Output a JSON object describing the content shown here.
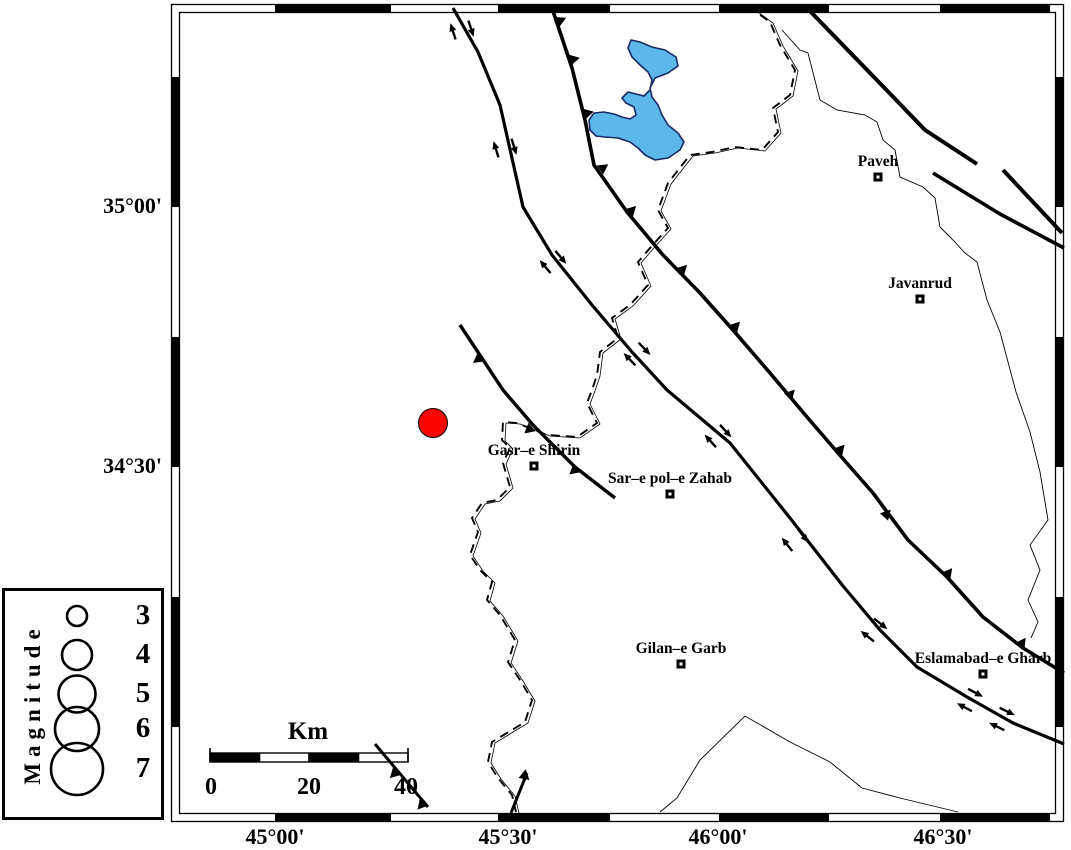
{
  "map": {
    "colors": {
      "water": "#5cb8e8",
      "water_outline": "#1a2a66",
      "epicenter": "#fa0400",
      "line": "#000000"
    },
    "frame": {
      "outer": [
        171.5,
        4.5,
        1063.5,
        821.5
      ],
      "inner": [
        179.5,
        12.5,
        1055.5,
        813.5
      ],
      "top_segs": [
        [
          275,
          391
        ],
        [
          498,
          610
        ],
        [
          719,
          829
        ],
        [
          940,
          1050
        ]
      ],
      "bottom_segs": [
        [
          275,
          391
        ],
        [
          498,
          610
        ],
        [
          719,
          829
        ],
        [
          940,
          1050
        ]
      ],
      "left_segs": [
        [
          77,
          207
        ],
        [
          337,
          467
        ],
        [
          597,
          727
        ]
      ],
      "right_segs": [
        [
          77,
          207
        ],
        [
          337,
          467
        ],
        [
          597,
          727
        ]
      ]
    },
    "axis": {
      "left": [
        {
          "text": "35°00'",
          "y": 207
        },
        {
          "text": "34°30'",
          "y": 467
        }
      ],
      "bottom": [
        {
          "text": "45°00'",
          "x": 275
        },
        {
          "text": "45°30'",
          "x": 508
        },
        {
          "text": "46°00'",
          "x": 718
        },
        {
          "text": "46°30'",
          "x": 943
        }
      ]
    },
    "lake": {
      "points": [
        [
          631,
          40
        ],
        [
          640,
          42
        ],
        [
          652,
          47
        ],
        [
          665,
          50
        ],
        [
          676,
          57
        ],
        [
          678,
          66
        ],
        [
          668,
          73
        ],
        [
          655,
          78
        ],
        [
          650,
          88
        ],
        [
          652,
          97
        ],
        [
          658,
          105
        ],
        [
          662,
          115
        ],
        [
          668,
          125
        ],
        [
          678,
          133
        ],
        [
          684,
          142
        ],
        [
          680,
          150
        ],
        [
          668,
          158
        ],
        [
          655,
          160
        ],
        [
          645,
          155
        ],
        [
          638,
          148
        ],
        [
          630,
          142
        ],
        [
          618,
          138
        ],
        [
          605,
          137
        ],
        [
          596,
          136
        ],
        [
          590,
          130
        ],
        [
          589,
          120
        ],
        [
          594,
          113
        ],
        [
          604,
          112
        ],
        [
          614,
          114
        ],
        [
          622,
          117
        ],
        [
          630,
          119
        ],
        [
          636,
          115
        ],
        [
          634,
          107
        ],
        [
          626,
          103
        ],
        [
          622,
          98
        ],
        [
          628,
          92
        ],
        [
          636,
          94
        ],
        [
          644,
          96
        ],
        [
          650,
          90
        ],
        [
          652,
          80
        ],
        [
          648,
          72
        ],
        [
          640,
          65
        ],
        [
          632,
          57
        ],
        [
          628,
          48
        ]
      ]
    },
    "border": {
      "points": [
        [
          748,
          6
        ],
        [
          770,
          22
        ],
        [
          780,
          45
        ],
        [
          795,
          70
        ],
        [
          790,
          95
        ],
        [
          773,
          108
        ],
        [
          778,
          132
        ],
        [
          762,
          150
        ],
        [
          735,
          147
        ],
        [
          712,
          152
        ],
        [
          690,
          155
        ],
        [
          668,
          183
        ],
        [
          658,
          210
        ],
        [
          668,
          228
        ],
        [
          650,
          248
        ],
        [
          638,
          262
        ],
        [
          648,
          285
        ],
        [
          630,
          305
        ],
        [
          612,
          318
        ],
        [
          618,
          338
        ],
        [
          600,
          352
        ],
        [
          597,
          375
        ],
        [
          592,
          390
        ],
        [
          587,
          403
        ],
        [
          597,
          423
        ],
        [
          577,
          437
        ],
        [
          547,
          435
        ],
        [
          517,
          423
        ],
        [
          503,
          422
        ],
        [
          502,
          440
        ],
        [
          510,
          448
        ],
        [
          503,
          463
        ],
        [
          510,
          487
        ],
        [
          497,
          500
        ],
        [
          482,
          503
        ],
        [
          472,
          518
        ],
        [
          478,
          532
        ],
        [
          470,
          555
        ],
        [
          480,
          570
        ],
        [
          492,
          582
        ],
        [
          487,
          600
        ],
        [
          500,
          615
        ],
        [
          515,
          640
        ],
        [
          508,
          662
        ],
        [
          520,
          680
        ],
        [
          532,
          700
        ],
        [
          525,
          722
        ],
        [
          492,
          742
        ],
        [
          488,
          762
        ],
        [
          498,
          778
        ],
        [
          512,
          795
        ],
        [
          516,
          812
        ]
      ]
    },
    "rivers": [
      {
        "id": "river-northeast",
        "points": [
          [
            782,
            30
          ],
          [
            800,
            50
          ],
          [
            808,
            53
          ],
          [
            820,
            100
          ],
          [
            837,
            110
          ],
          [
            865,
            115
          ],
          [
            877,
            122
          ],
          [
            883,
            140
          ],
          [
            895,
            150
          ],
          [
            900,
            177
          ],
          [
            923,
            187
          ],
          [
            935,
            198
          ],
          [
            940,
            227
          ],
          [
            953,
            240
          ],
          [
            965,
            253
          ],
          [
            977,
            262
          ],
          [
            987,
            300
          ],
          [
            1000,
            332
          ],
          [
            1008,
            362
          ],
          [
            1016,
            392
          ],
          [
            1030,
            432
          ],
          [
            1040,
            472
          ],
          [
            1048,
            520
          ],
          [
            1030,
            545
          ],
          [
            1040,
            570
          ],
          [
            1028,
            600
          ],
          [
            1038,
            622
          ],
          [
            1031,
            638
          ]
        ]
      },
      {
        "id": "river-south",
        "points": [
          [
            660,
            812
          ],
          [
            677,
            798
          ],
          [
            700,
            760
          ],
          [
            745,
            716
          ],
          [
            790,
            742
          ],
          [
            830,
            762
          ],
          [
            862,
            788
          ],
          [
            900,
            798
          ],
          [
            958,
            812
          ]
        ]
      }
    ],
    "faults": [
      {
        "id": "main-recent-fault",
        "width": 3.2,
        "points": [
          [
            453,
            8
          ],
          [
            478,
            52
          ],
          [
            500,
            105
          ],
          [
            523,
            207
          ],
          [
            552,
            255
          ],
          [
            592,
            305
          ],
          [
            632,
            352
          ],
          [
            667,
            390
          ],
          [
            730,
            443
          ],
          [
            790,
            518
          ],
          [
            843,
            586
          ],
          [
            880,
            630
          ],
          [
            917,
            667
          ],
          [
            967,
            697
          ],
          [
            1013,
            723
          ],
          [
            1064,
            744
          ]
        ]
      },
      {
        "id": "mountain-front-fault",
        "width": 3.6,
        "points": [
          [
            552,
            8
          ],
          [
            572,
            68
          ],
          [
            585,
            120
          ],
          [
            594,
            165
          ],
          [
            627,
            212
          ],
          [
            663,
            255
          ],
          [
            700,
            293
          ],
          [
            733,
            330
          ],
          [
            770,
            373
          ],
          [
            807,
            417
          ],
          [
            838,
            453
          ],
          [
            873,
            493
          ],
          [
            908,
            540
          ],
          [
            947,
            577
          ],
          [
            983,
            617
          ],
          [
            1023,
            648
          ],
          [
            1064,
            673
          ]
        ]
      },
      {
        "id": "qasr-thrust-fault",
        "width": 3.4,
        "points": [
          [
            460,
            325
          ],
          [
            503,
            390
          ],
          [
            533,
            425
          ],
          [
            575,
            467
          ],
          [
            615,
            498
          ]
        ]
      },
      {
        "id": "northeast-fault-1",
        "width": 4,
        "points": [
          [
            807,
            8
          ],
          [
            900,
            104
          ],
          [
            925,
            130
          ],
          [
            977,
            164
          ]
        ]
      },
      {
        "id": "northeast-fault-2",
        "width": 4,
        "points": [
          [
            1003,
            170
          ],
          [
            1062,
            233
          ]
        ]
      },
      {
        "id": "northeast-fault-3",
        "width": 3.6,
        "points": [
          [
            933,
            173
          ],
          [
            1000,
            214
          ],
          [
            1064,
            248
          ]
        ]
      },
      {
        "id": "southwest-fault-1",
        "width": 3,
        "points": [
          [
            375,
            744
          ],
          [
            428,
            807
          ]
        ]
      },
      {
        "id": "southwest-fault-2",
        "width": 3,
        "points": [
          [
            527,
            773
          ],
          [
            511,
            813
          ]
        ]
      }
    ],
    "thrust_teeth": [
      {
        "x": 557,
        "y": 22,
        "r": -25
      },
      {
        "x": 570,
        "y": 60,
        "r": -12
      },
      {
        "x": 584,
        "y": 114,
        "r": -14
      },
      {
        "x": 600,
        "y": 170,
        "r": -35
      },
      {
        "x": 629,
        "y": 213,
        "r": -45
      },
      {
        "x": 680,
        "y": 272,
        "r": -45
      },
      {
        "x": 733,
        "y": 329,
        "r": -46
      },
      {
        "x": 788,
        "y": 397,
        "r": -48
      },
      {
        "x": 838,
        "y": 452,
        "r": -48
      },
      {
        "x": 884,
        "y": 517,
        "r": -48
      },
      {
        "x": 946,
        "y": 576,
        "r": -52
      },
      {
        "x": 1020,
        "y": 646,
        "r": -56
      },
      {
        "x": 481,
        "y": 357,
        "r": 143
      },
      {
        "x": 532,
        "y": 427,
        "r": 140
      },
      {
        "x": 577,
        "y": 468,
        "r": 140
      },
      {
        "x": 397,
        "y": 771,
        "r": 135
      },
      {
        "x": 424,
        "y": 802,
        "r": 130
      },
      {
        "x": 524,
        "y": 779,
        "r": -80
      }
    ],
    "slip_arrow_pairs": [
      {
        "x": 462,
        "y": 30,
        "a": 72
      },
      {
        "x": 505,
        "y": 148,
        "a": 73
      },
      {
        "x": 553,
        "y": 262,
        "a": 50
      },
      {
        "x": 637,
        "y": 354,
        "a": 46
      },
      {
        "x": 718,
        "y": 436,
        "a": 48
      },
      {
        "x": 795,
        "y": 540,
        "a": 52
      },
      {
        "x": 874,
        "y": 630,
        "a": 38
      },
      {
        "x": 970,
        "y": 700,
        "a": 28
      },
      {
        "x": 1002,
        "y": 719,
        "a": 26
      }
    ],
    "cities": [
      {
        "name": "Paveh",
        "x": 878,
        "y": 177
      },
      {
        "name": "Javanrud",
        "x": 920,
        "y": 299
      },
      {
        "name": "Gasr–e Shirin",
        "x": 534,
        "y": 466
      },
      {
        "name": "Sar–e pol–e Zahab",
        "x": 670,
        "y": 494
      },
      {
        "name": "Gilan–e Garb",
        "x": 681,
        "y": 664
      },
      {
        "name": "Eslamabad–e Gharb",
        "x": 983,
        "y": 674
      }
    ],
    "epicenter": {
      "x": 433,
      "y": 423,
      "r": 14.5
    }
  },
  "legend": {
    "title": "Magnitude",
    "items": [
      {
        "label": "3",
        "r": 10,
        "cy": 25,
        "num_top": 8
      },
      {
        "label": "4",
        "r": 15,
        "cy": 64,
        "num_top": 47
      },
      {
        "label": "5",
        "r": 18.5,
        "cy": 103,
        "num_top": 86
      },
      {
        "label": "6",
        "r": 22,
        "cy": 138,
        "num_top": 121
      },
      {
        "label": "7",
        "r": 26,
        "cy": 178,
        "num_top": 161
      }
    ],
    "circle_cx": 72
  },
  "scalebar": {
    "km_label": "Km",
    "tick_labels": [
      "0",
      "20",
      "40"
    ],
    "x": 210,
    "y": 753,
    "width": 198,
    "height": 9,
    "fill_pattern": [
      "black",
      "white",
      "black",
      "white"
    ]
  }
}
